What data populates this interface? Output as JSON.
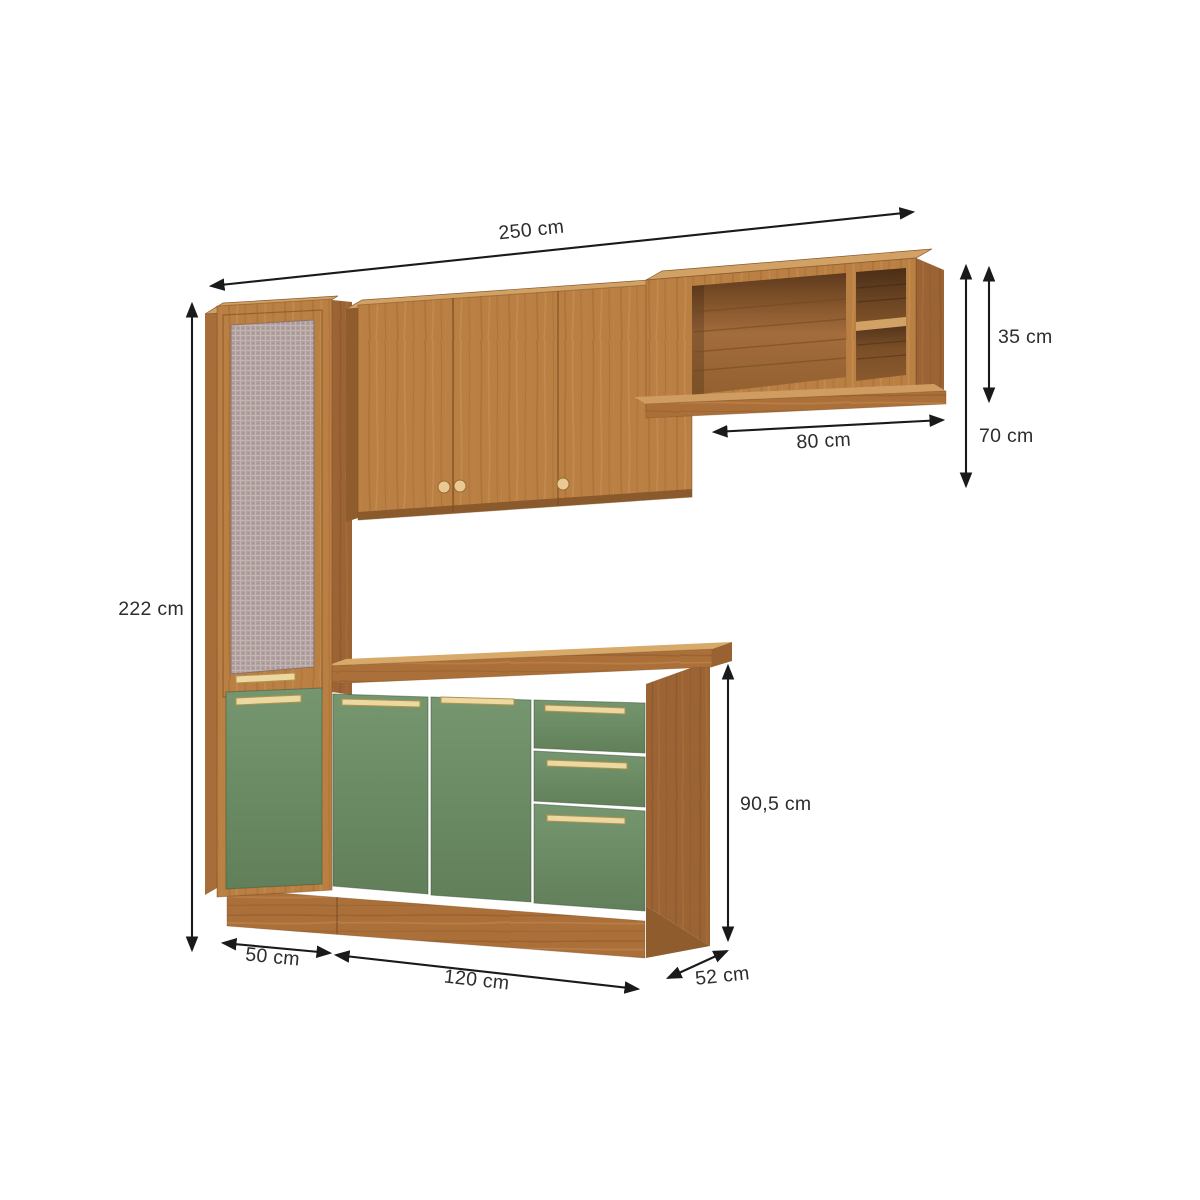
{
  "diagram": {
    "subject": "kitchen-cabinet-set-dimension-diagram",
    "background": "#ffffff",
    "labels": {
      "total_width": "250 cm",
      "total_height": "222 cm",
      "upper_shelf_height": "35 cm",
      "wall_section_height": "70 cm",
      "shelf_opening_width": "80 cm",
      "base_cabinet_height": "90,5 cm",
      "tall_cabinet_width": "50 cm",
      "base_cabinet_width": "120 cm",
      "cabinet_depth": "52 cm"
    },
    "colors": {
      "wood_front": "#b97f43",
      "wood_top": "#d2a165",
      "wood_side": "#9c6434",
      "wood_plinth": "#ab703a",
      "door_green": "#6f9169",
      "handle_gold": "#ecd9a2",
      "knob_tan": "#eac893",
      "mesh_panel": "#b2a1a1",
      "dimension_line": "#1a1a1a",
      "label_text": "#2d2d2d"
    }
  }
}
